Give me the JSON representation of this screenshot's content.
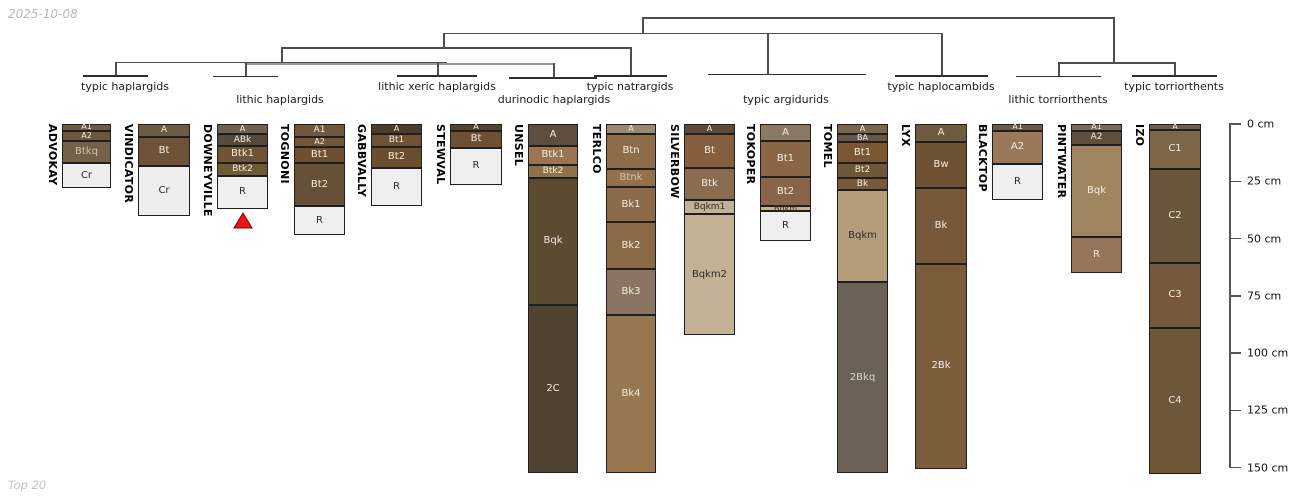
{
  "meta": {
    "date_label": "2025-10-08",
    "footer_label": "Top 20"
  },
  "chart_data": {
    "type": "bar",
    "subtype": "stacked soil-horizon depth columns grouped by a dendrogram of soil great-group taxa",
    "title": "",
    "ylabel": "depth (cm)",
    "ylim": [
      0,
      150
    ],
    "y_ticks": [
      0,
      25,
      50,
      75,
      100,
      125,
      150
    ],
    "y_tick_labels": [
      "0 cm",
      "25 cm",
      "50 cm",
      "75 cm",
      "100 cm",
      "125 cm",
      "150 cm"
    ],
    "legend": "none",
    "grid": false,
    "groups": [
      {
        "label": "typic haplargids",
        "cx": 125,
        "row": 1,
        "columns": [
          "ADVOKAY",
          "VINDICATOR"
        ]
      },
      {
        "label": "lithic haplargids",
        "cx": 280,
        "row": 2,
        "columns": [
          "DOWNEYVILLE",
          "TOGNONI"
        ]
      },
      {
        "label": "lithic xeric haplargids",
        "cx": 437,
        "row": 1,
        "columns": [
          "GABBVALLY",
          "STEWVAL"
        ]
      },
      {
        "label": "durinodic haplargids",
        "cx": 554,
        "row": 2,
        "columns": [
          "UNSEL"
        ]
      },
      {
        "label": "typic natrargids",
        "cx": 630,
        "row": 1,
        "columns": [
          "TERLCO"
        ]
      },
      {
        "label": "typic argidurids",
        "cx": 786,
        "row": 2,
        "columns": [
          "SILVERBOW",
          "TOKOPER",
          "TOMEL"
        ]
      },
      {
        "label": "typic haplocambids",
        "cx": 941,
        "row": 1,
        "columns": [
          "LYX"
        ]
      },
      {
        "label": "lithic torriorthents",
        "cx": 1058,
        "row": 2,
        "columns": [
          "BLACKTOP",
          "PINTWATER"
        ]
      },
      {
        "label": "typic torriorthents",
        "cx": 1174,
        "row": 1,
        "columns": [
          "IZO"
        ]
      }
    ],
    "dendrogram": {
      "h_lines": [
        [
          115,
          447,
          61.5,
          "dark"
        ],
        [
          245,
          553,
          63,
          "gray"
        ],
        [
          281,
          630,
          47,
          "dark"
        ],
        [
          443,
          941,
          32.5,
          "dark"
        ],
        [
          642,
          1113,
          17,
          "dark"
        ],
        [
          1058,
          1174,
          62,
          "dark"
        ]
      ],
      "v_lines": [
        [
          115,
          61.5,
          75.5,
          "dark"
        ],
        [
          245,
          63,
          76,
          "dark"
        ],
        [
          437,
          62,
          75.5,
          "dark"
        ],
        [
          553,
          63,
          77,
          "dark"
        ],
        [
          630,
          47,
          75.5,
          "dark"
        ],
        [
          281,
          47,
          61.5,
          "dark"
        ],
        [
          443,
          32.5,
          47,
          "dark"
        ],
        [
          767,
          32.5,
          74,
          "dark"
        ],
        [
          941,
          32.5,
          75.5,
          "dark"
        ],
        [
          642,
          17,
          32.5,
          "dark"
        ],
        [
          1113,
          17,
          62,
          "dark"
        ],
        [
          1058,
          62,
          76,
          "dark"
        ],
        [
          1174,
          62,
          75.5,
          "dark"
        ]
      ],
      "overlines": [
        [
          83,
          148,
          75
        ],
        [
          213,
          278,
          75.5
        ],
        [
          397,
          477,
          75
        ],
        [
          509,
          597,
          77
        ],
        [
          594,
          667,
          75
        ],
        [
          708,
          866,
          73.5
        ],
        [
          895,
          988,
          75
        ],
        [
          1016,
          1101,
          75.5
        ],
        [
          1132,
          1217,
          75
        ]
      ]
    },
    "marker": {
      "column": "DOWNEYVILLE",
      "shape": "triangle-up",
      "fill": "#ee1414",
      "edge": "#7a0000"
    },
    "series": [
      {
        "name": "ADVOKAY",
        "px": {
          "x": 62,
          "w": 49
        },
        "horizons": [
          {
            "label": "A1",
            "top": 0,
            "bottom": 3,
            "color": "#705b40"
          },
          {
            "label": "A2",
            "top": 3,
            "bottom": 7.5,
            "color": "#6b573d"
          },
          {
            "label": "Btkq",
            "top": 7.5,
            "bottom": 17,
            "color": "#75604a",
            "tc": "#c9c1b2"
          },
          {
            "label": "Cr",
            "top": 17,
            "bottom": 28,
            "color": "#eeeeee"
          }
        ]
      },
      {
        "name": "VINDICATOR",
        "px": {
          "x": 138,
          "w": 52
        },
        "horizons": [
          {
            "label": "A",
            "top": 0,
            "bottom": 5.5,
            "color": "#6f5b41"
          },
          {
            "label": "Bt",
            "top": 5.5,
            "bottom": 18.5,
            "color": "#6f5338"
          },
          {
            "label": "Cr",
            "top": 18.5,
            "bottom": 40,
            "color": "#eeeeee"
          }
        ]
      },
      {
        "name": "DOWNEYVILLE",
        "px": {
          "x": 217,
          "w": 51
        },
        "marker": true,
        "horizons": [
          {
            "label": "A",
            "top": 0,
            "bottom": 4.5,
            "color": "#6f6050"
          },
          {
            "label": "ABk",
            "top": 4.5,
            "bottom": 9.5,
            "color": "#584a3a"
          },
          {
            "label": "Btk1",
            "top": 9.5,
            "bottom": 17,
            "color": "#6f5438"
          },
          {
            "label": "Btk2",
            "top": 17,
            "bottom": 22.5,
            "color": "#6f5a36"
          },
          {
            "label": "R",
            "top": 22.5,
            "bottom": 37,
            "color": "#efefef"
          }
        ]
      },
      {
        "name": "TOGNONI",
        "px": {
          "x": 294,
          "w": 51
        },
        "horizons": [
          {
            "label": "A1",
            "top": 0,
            "bottom": 5.5,
            "color": "#72583a"
          },
          {
            "label": "A2",
            "top": 5.5,
            "bottom": 10,
            "color": "#6f5638"
          },
          {
            "label": "Bt1",
            "top": 10,
            "bottom": 17,
            "color": "#6e4f31"
          },
          {
            "label": "Bt2",
            "top": 17,
            "bottom": 36,
            "color": "#665138"
          },
          {
            "label": "R",
            "top": 36,
            "bottom": 48.5,
            "color": "#efefef"
          }
        ]
      },
      {
        "name": "GABBVALLY",
        "px": {
          "x": 371,
          "w": 51
        },
        "horizons": [
          {
            "label": "A",
            "top": 0,
            "bottom": 4.5,
            "color": "#4c3c29"
          },
          {
            "label": "Bt1",
            "top": 4.5,
            "bottom": 10,
            "color": "#6f5233"
          },
          {
            "label": "Bt2",
            "top": 10,
            "bottom": 19,
            "color": "#6b4e30"
          },
          {
            "label": "R",
            "top": 19,
            "bottom": 36,
            "color": "#efefef"
          }
        ]
      },
      {
        "name": "STEWVAL",
        "px": {
          "x": 450,
          "w": 52
        },
        "horizons": [
          {
            "label": "A",
            "top": 0,
            "bottom": 3,
            "color": "#55432d"
          },
          {
            "label": "Bt",
            "top": 3,
            "bottom": 10.5,
            "color": "#6f5034"
          },
          {
            "label": "R",
            "top": 10.5,
            "bottom": 26.5,
            "color": "#efefef"
          }
        ]
      },
      {
        "name": "UNSEL",
        "px": {
          "x": 528,
          "w": 50
        },
        "horizons": [
          {
            "label": "A",
            "top": 0,
            "bottom": 9.5,
            "color": "#5d4e3d"
          },
          {
            "label": "Btk1",
            "top": 9.5,
            "bottom": 18,
            "color": "#9c7453"
          },
          {
            "label": "Btk2",
            "top": 18,
            "bottom": 23.5,
            "color": "#8d7347"
          },
          {
            "label": "Bqk",
            "top": 23.5,
            "bottom": 79,
            "color": "#5d4a33"
          },
          {
            "label": "2C",
            "top": 79,
            "bottom": 152.5,
            "color": "#4f432f"
          }
        ]
      },
      {
        "name": "TERLCO",
        "px": {
          "x": 606,
          "w": 50
        },
        "horizons": [
          {
            "label": "A",
            "top": 0,
            "bottom": 4.5,
            "color": "#9a8a74"
          },
          {
            "label": "Btn",
            "top": 4.5,
            "bottom": 19.5,
            "color": "#8d6c4a"
          },
          {
            "label": "Btnk",
            "top": 19.5,
            "bottom": 27.5,
            "color": "#93714d",
            "tc": "#cfc5b4"
          },
          {
            "label": "Bk1",
            "top": 27.5,
            "bottom": 43,
            "color": "#8b6b49"
          },
          {
            "label": "Bk2",
            "top": 43,
            "bottom": 63.5,
            "color": "#8a6a46"
          },
          {
            "label": "Bk3",
            "top": 63.5,
            "bottom": 83.5,
            "color": "#8b7562"
          },
          {
            "label": "Bk4",
            "top": 83.5,
            "bottom": 152.5,
            "color": "#977850"
          }
        ]
      },
      {
        "name": "SILVERBOW",
        "px": {
          "x": 684,
          "w": 51
        },
        "horizons": [
          {
            "label": "A",
            "top": 0,
            "bottom": 4.5,
            "color": "#5e4b37"
          },
          {
            "label": "Bt",
            "top": 4.5,
            "bottom": 19,
            "color": "#855f3e"
          },
          {
            "label": "Btk",
            "top": 19,
            "bottom": 33,
            "color": "#8a6c50"
          },
          {
            "label": "Bqkm1",
            "top": 33,
            "bottom": 39.5,
            "color": "#c3b295"
          },
          {
            "label": "Bqkm2",
            "top": 39.5,
            "bottom": 92,
            "color": "#c2b194"
          }
        ]
      },
      {
        "name": "TOKOPER",
        "px": {
          "x": 760,
          "w": 51
        },
        "horizons": [
          {
            "label": "A",
            "top": 0,
            "bottom": 7.5,
            "color": "#8a7a64"
          },
          {
            "label": "Bt1",
            "top": 7.5,
            "bottom": 23,
            "color": "#8a6546"
          },
          {
            "label": "Bt2",
            "top": 23,
            "bottom": 36,
            "color": "#88644a"
          },
          {
            "label": "Bqkm",
            "top": 36,
            "bottom": 38,
            "color": "#c3b295",
            "tc": "#3a3328"
          },
          {
            "label": "R",
            "top": 38,
            "bottom": 51,
            "color": "#efefef"
          }
        ]
      },
      {
        "name": "TOMEL",
        "px": {
          "x": 837,
          "w": 51
        },
        "horizons": [
          {
            "label": "A",
            "top": 0,
            "bottom": 4.5,
            "color": "#77654e"
          },
          {
            "label": "BA",
            "top": 4.5,
            "bottom": 8,
            "color": "#655747"
          },
          {
            "label": "Bt1",
            "top": 8,
            "bottom": 17,
            "color": "#7a5731"
          },
          {
            "label": "Bt2",
            "top": 17,
            "bottom": 23.5,
            "color": "#6e563a"
          },
          {
            "label": "Bk",
            "top": 23.5,
            "bottom": 29,
            "color": "#77593a"
          },
          {
            "label": "Bqkm",
            "top": 29,
            "bottom": 69,
            "color": "#b59d7c"
          },
          {
            "label": "2Bkq",
            "top": 69,
            "bottom": 152.5,
            "color": "#6b6156",
            "tc": "#d8d4cc"
          }
        ]
      },
      {
        "name": "LYX",
        "px": {
          "x": 915,
          "w": 52
        },
        "horizons": [
          {
            "label": "A",
            "top": 0,
            "bottom": 8,
            "color": "#6e5b40"
          },
          {
            "label": "Bw",
            "top": 8,
            "bottom": 28,
            "color": "#6e5032"
          },
          {
            "label": "Bk",
            "top": 28,
            "bottom": 61,
            "color": "#77593a"
          },
          {
            "label": "2Bk",
            "top": 61,
            "bottom": 150.5,
            "color": "#7b5c3b"
          }
        ]
      },
      {
        "name": "BLACKTOP",
        "px": {
          "x": 992,
          "w": 51
        },
        "horizons": [
          {
            "label": "A1",
            "top": 0,
            "bottom": 3,
            "color": "#6b5a45"
          },
          {
            "label": "A2",
            "top": 3,
            "bottom": 17.5,
            "color": "#997959"
          },
          {
            "label": "R",
            "top": 17.5,
            "bottom": 33,
            "color": "#efefef"
          }
        ]
      },
      {
        "name": "PINTWATER",
        "px": {
          "x": 1071,
          "w": 51
        },
        "horizons": [
          {
            "label": "A1",
            "top": 0,
            "bottom": 3,
            "color": "#7a6a52"
          },
          {
            "label": "A2",
            "top": 3,
            "bottom": 9,
            "color": "#5d4e3d"
          },
          {
            "label": "Bqk",
            "top": 9,
            "bottom": 49.5,
            "color": "#a08560"
          },
          {
            "label": "R",
            "top": 49.5,
            "bottom": 65,
            "color": "#97755a"
          }
        ]
      },
      {
        "name": "IZO",
        "px": {
          "x": 1149,
          "w": 52
        },
        "horizons": [
          {
            "label": "A",
            "top": 0,
            "bottom": 2.5,
            "color": "#6e5c48"
          },
          {
            "label": "C1",
            "top": 2.5,
            "bottom": 19.5,
            "color": "#7d6548"
          },
          {
            "label": "C2",
            "top": 19.5,
            "bottom": 60.5,
            "color": "#6b563c"
          },
          {
            "label": "C3",
            "top": 60.5,
            "bottom": 89,
            "color": "#75593a"
          },
          {
            "label": "C4",
            "top": 89,
            "bottom": 153,
            "color": "#6e5638"
          }
        ]
      }
    ]
  }
}
